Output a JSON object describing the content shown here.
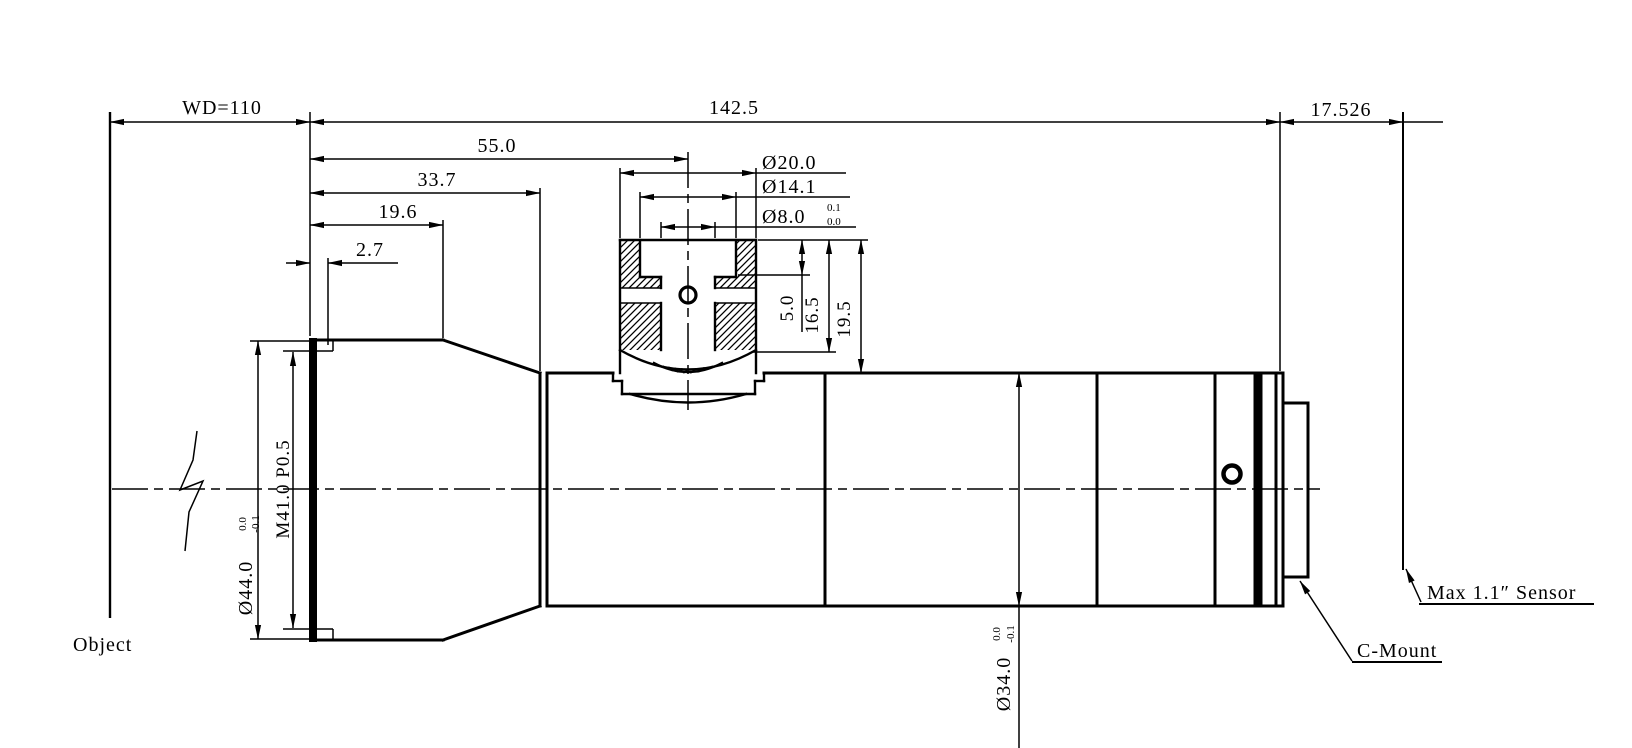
{
  "meta": {
    "background": "#ffffff",
    "line_color": "#000000",
    "drawing_type": "lens mechanical outline drawing"
  },
  "labels": {
    "object": "Object",
    "sensor": "Max 1.1″ Sensor",
    "c_mount": "C-Mount"
  },
  "dims": {
    "wd": "WD=110",
    "overall_length": "142.5",
    "flange_distance": "17.526",
    "port_center_offset": "55.0",
    "front_section_length": "33.7",
    "front_barrel_length": "19.6",
    "thread_depth": "2.7",
    "port_outer_dia": "Ø20.0",
    "port_mid_dia": "Ø14.1",
    "port_bore_dia": "Ø8.0",
    "port_bore_tol_hi": "0.1",
    "port_bore_tol_lo": "0.0",
    "port_step_depth": "5.0",
    "port_mid_depth": "16.5",
    "port_total_height": "19.5",
    "front_dia": "Ø44.0",
    "front_dia_tol_hi": "0.0",
    "front_dia_tol_lo": "-0.1",
    "front_thread": "M41.0 P0.5",
    "barrel_dia": "Ø34.0",
    "barrel_dia_tol_hi": "0.0",
    "barrel_dia_tol_lo": "-0.1"
  }
}
